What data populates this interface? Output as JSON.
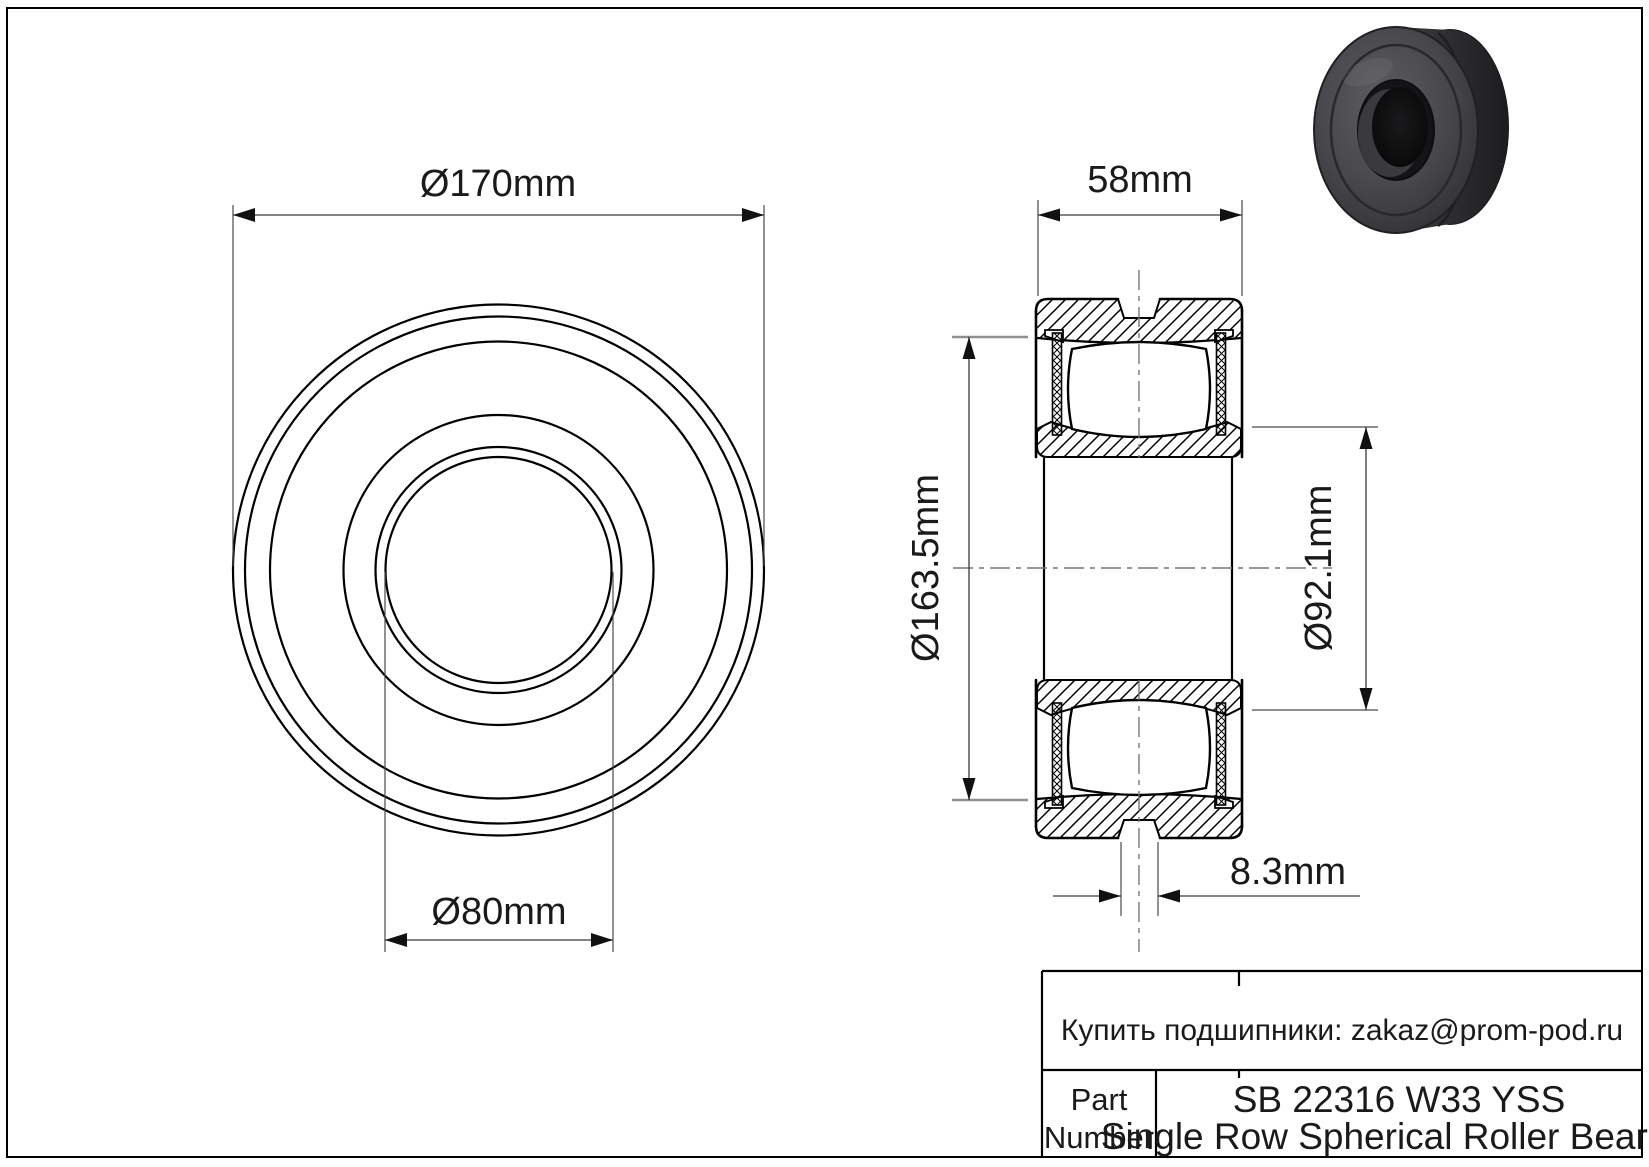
{
  "sheet": {
    "background": "#ffffff",
    "line_color": "#000000",
    "dim_line_color": "#3a3a3a",
    "ext_line_gray": "#8f8f8f",
    "render_body_color": "#3c3c40"
  },
  "front_view": {
    "outer_diameter_label": "Ø170mm",
    "bore_diameter_label": "Ø80mm"
  },
  "section_view": {
    "width_label": "58mm",
    "outer_raceway_label": "Ø163.5mm",
    "inner_raceway_label": "Ø92.1mm",
    "groove_label": "8.3mm"
  },
  "title_block": {
    "contact": "Купить подшипники: zakaz@prom-pod.ru",
    "part_label": [
      "Part",
      "Number"
    ],
    "part_number": "SB 22316 W33 YSS",
    "description": "Single Row Spherical Roller Bearing"
  }
}
